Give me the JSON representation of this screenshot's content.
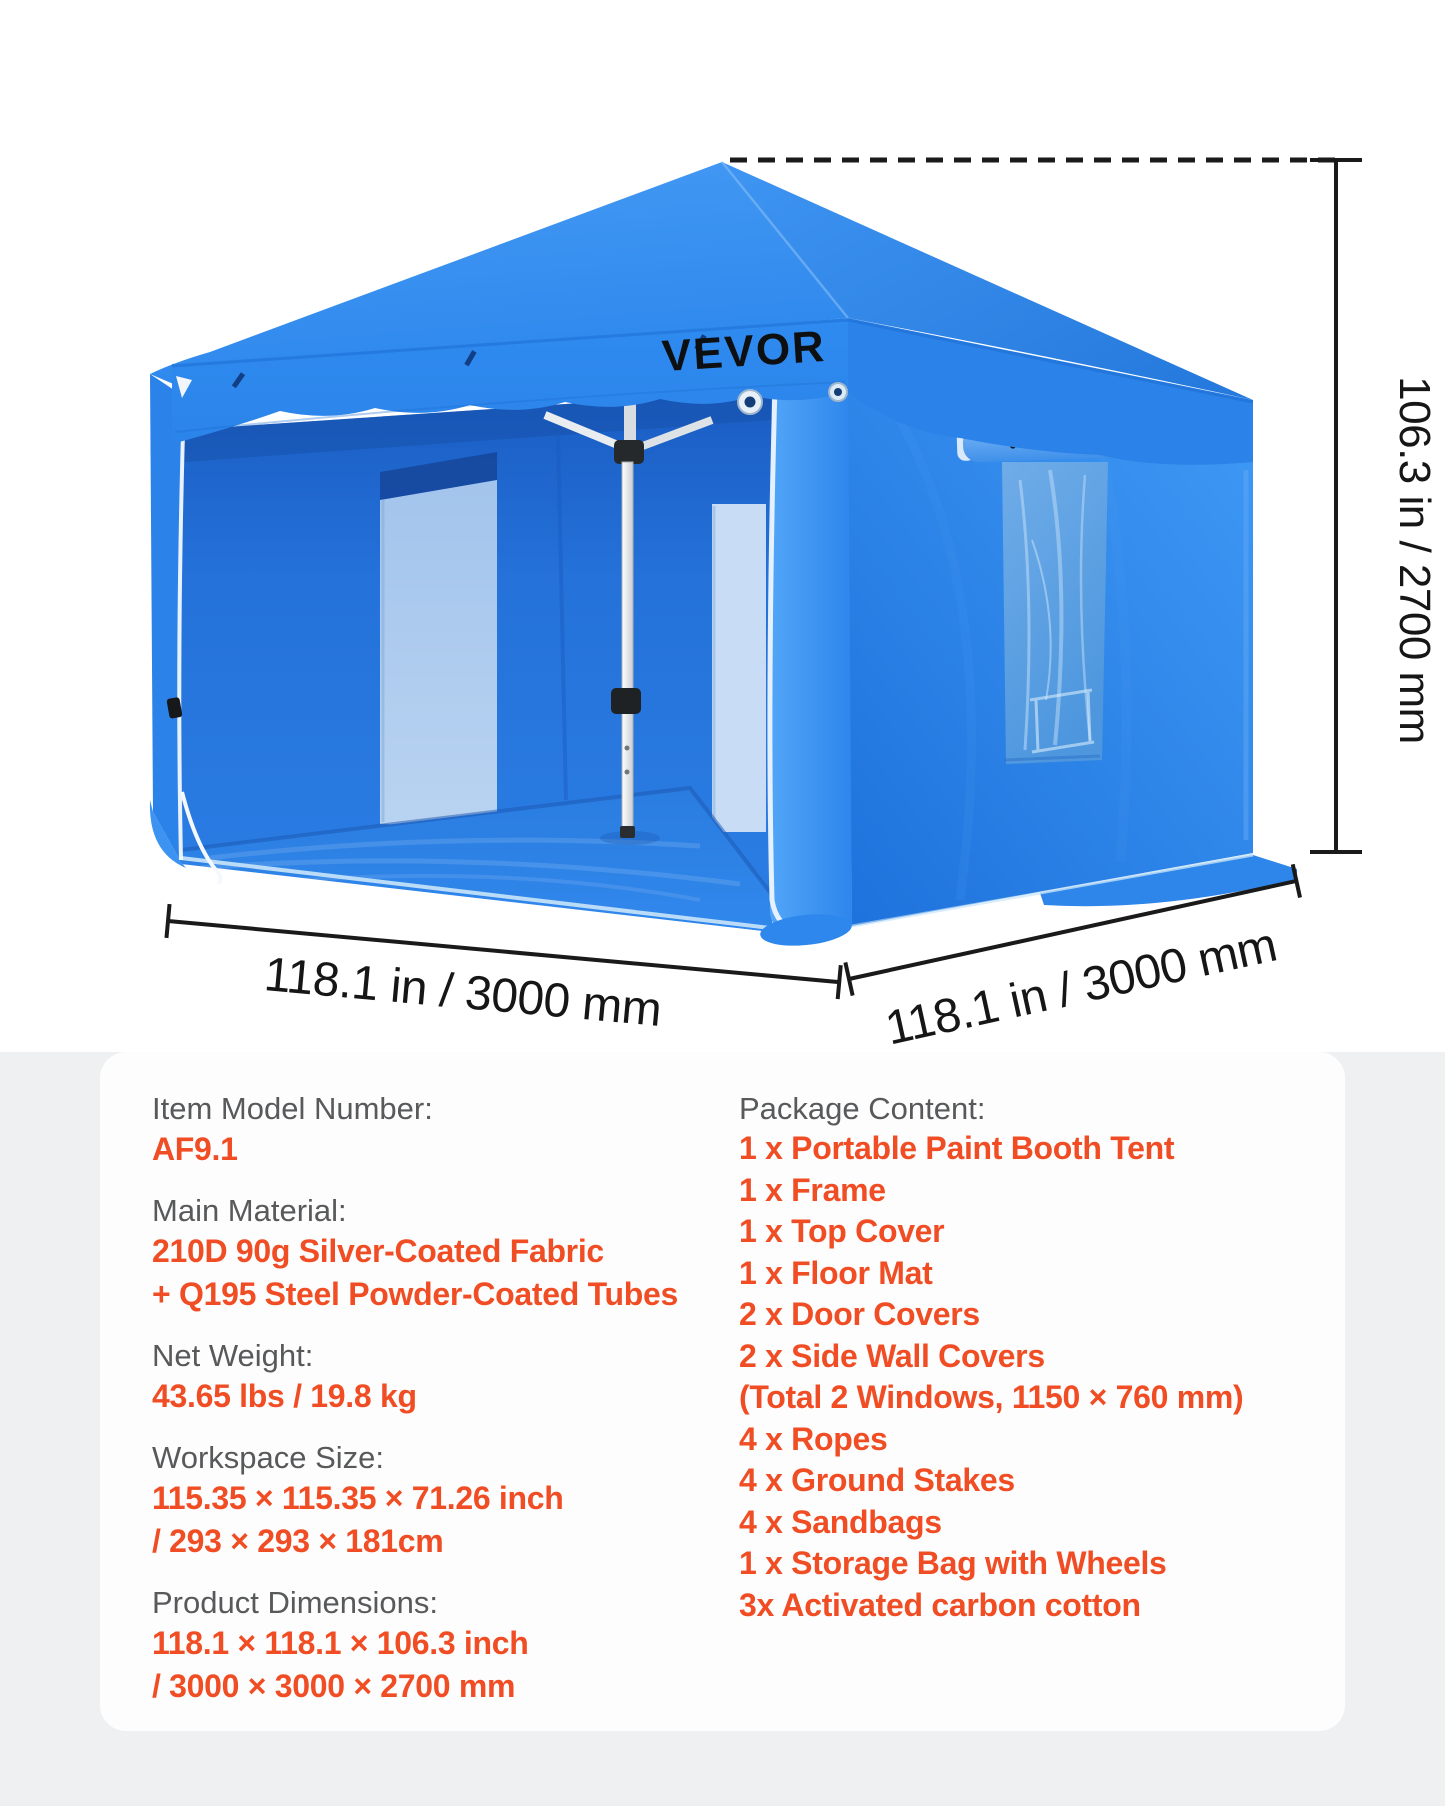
{
  "brand": {
    "logo_text": "VEVOR",
    "logo_color": "#101214"
  },
  "colors": {
    "accent_red": "#F04D24",
    "label_gray": "#58595B",
    "tent_blue": "#2E86EA",
    "dimension_line": "#1A1A1A",
    "section_background": "#EEF0F1",
    "card_background": "#FDFDFD"
  },
  "diagram": {
    "height_label": "106.3 in / 2700 mm",
    "width_left_label": "118.1 in / 3000 mm",
    "width_right_label": "118.1 in / 3000 mm"
  },
  "specs": {
    "groups": [
      {
        "label": "Item Model Number:",
        "lines": [
          "AF9.1"
        ]
      },
      {
        "label": "Main Material:",
        "lines": [
          "210D 90g Silver-Coated Fabric",
          "+ Q195 Steel Powder-Coated Tubes"
        ]
      },
      {
        "label": "Net Weight:",
        "lines": [
          "43.65 lbs / 19.8 kg"
        ]
      },
      {
        "label": "Workspace Size:",
        "lines": [
          "115.35 × 115.35 × 71.26 inch",
          "/ 293 × 293 × 181cm"
        ]
      },
      {
        "label": "Product Dimensions:",
        "lines": [
          "118.1 × 118.1 × 106.3 inch",
          "/ 3000 × 3000 × 2700 mm"
        ]
      }
    ],
    "package": {
      "label": "Package Content:",
      "items": [
        "1 x Portable Paint Booth Tent",
        "1 x Frame",
        "1 x Top Cover",
        "1 x Floor Mat",
        "2 x Door Covers",
        "2 x Side Wall Covers",
        "(Total 2 Windows, 1150 × 760 mm)",
        "4 x Ropes",
        "4 x Ground Stakes",
        "4 x Sandbags",
        "1 x Storage Bag with Wheels",
        "3x Activated carbon cotton"
      ]
    }
  }
}
